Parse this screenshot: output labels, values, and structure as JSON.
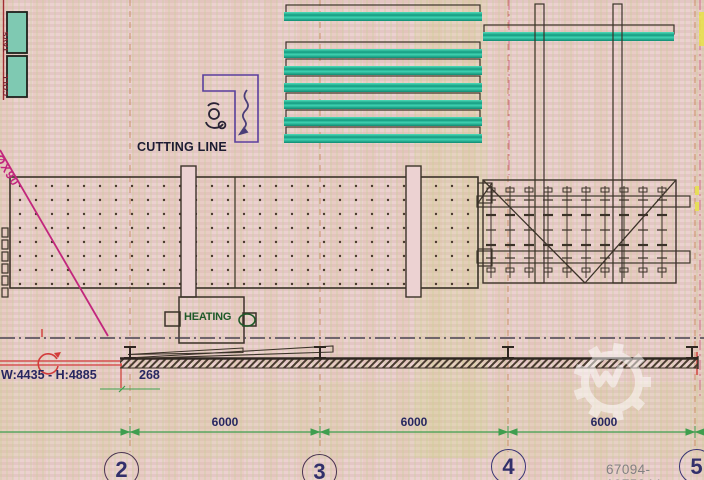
{
  "drawing": {
    "labels": {
      "cutting_line": "CUTTING LINE",
      "heating": "HEATING",
      "window_size": "W:4435 - H:4885",
      "offset_dim": "268",
      "pallet_box_top": "TAVS",
      "pallet_box_bottom": "COLL",
      "diagonal_note": "ØX90"
    },
    "dimensions": {
      "spans": [
        "6000",
        "6000",
        "6000"
      ]
    },
    "grid_bubbles": [
      "2",
      "3",
      "4",
      "5"
    ],
    "icons": [
      "operator-icon",
      "squiggle-arrow-icon",
      "rotation-arrow-icon",
      "i-beam-column-icon",
      "gear-watermark-icon"
    ],
    "colors": {
      "background": "#e9cbca",
      "teal_conveyor": "#2ec4a5",
      "dimension_green": "#3f9e4f",
      "annotation_navy": "#272760",
      "magenta": "#c2267d",
      "red": "#d23b3b",
      "grid_orange": "#c0804a",
      "purple_outline": "#5b3f9e",
      "heating_green": "#1e5a28",
      "highlight_yellow": "#e8e24a"
    }
  },
  "watermark": {
    "id_text": "67094-1975044"
  }
}
